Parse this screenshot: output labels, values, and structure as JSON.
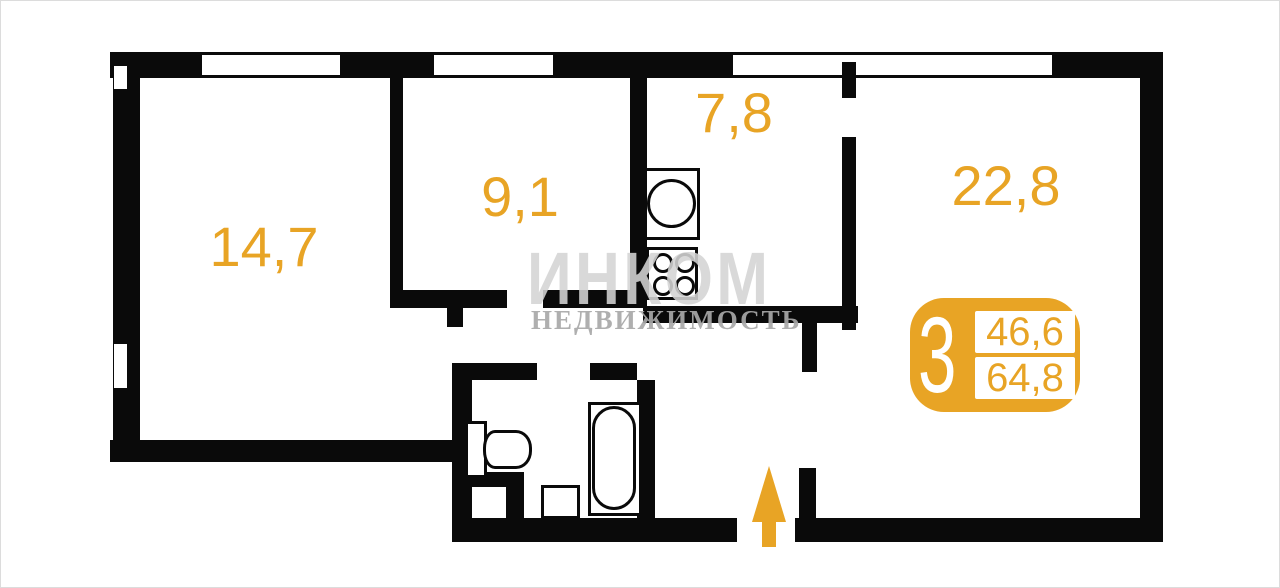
{
  "watermark": {
    "brand": "ИНКОМ",
    "tagline": "НЕДВИЖИМОСТЬ"
  },
  "rooms": {
    "room_left": {
      "label": "14,7"
    },
    "room_mid": {
      "label": "9,1"
    },
    "kitchen": {
      "label": "7,8"
    },
    "room_right": {
      "label": "22,8"
    }
  },
  "badge": {
    "rooms_count": "3",
    "value_top": "46,6",
    "value_bottom": "64,8"
  },
  "colors": {
    "accent_orange": "#E8A425",
    "wall_black": "#0A0A0A",
    "watermark_gray": "#D4D4D4"
  }
}
